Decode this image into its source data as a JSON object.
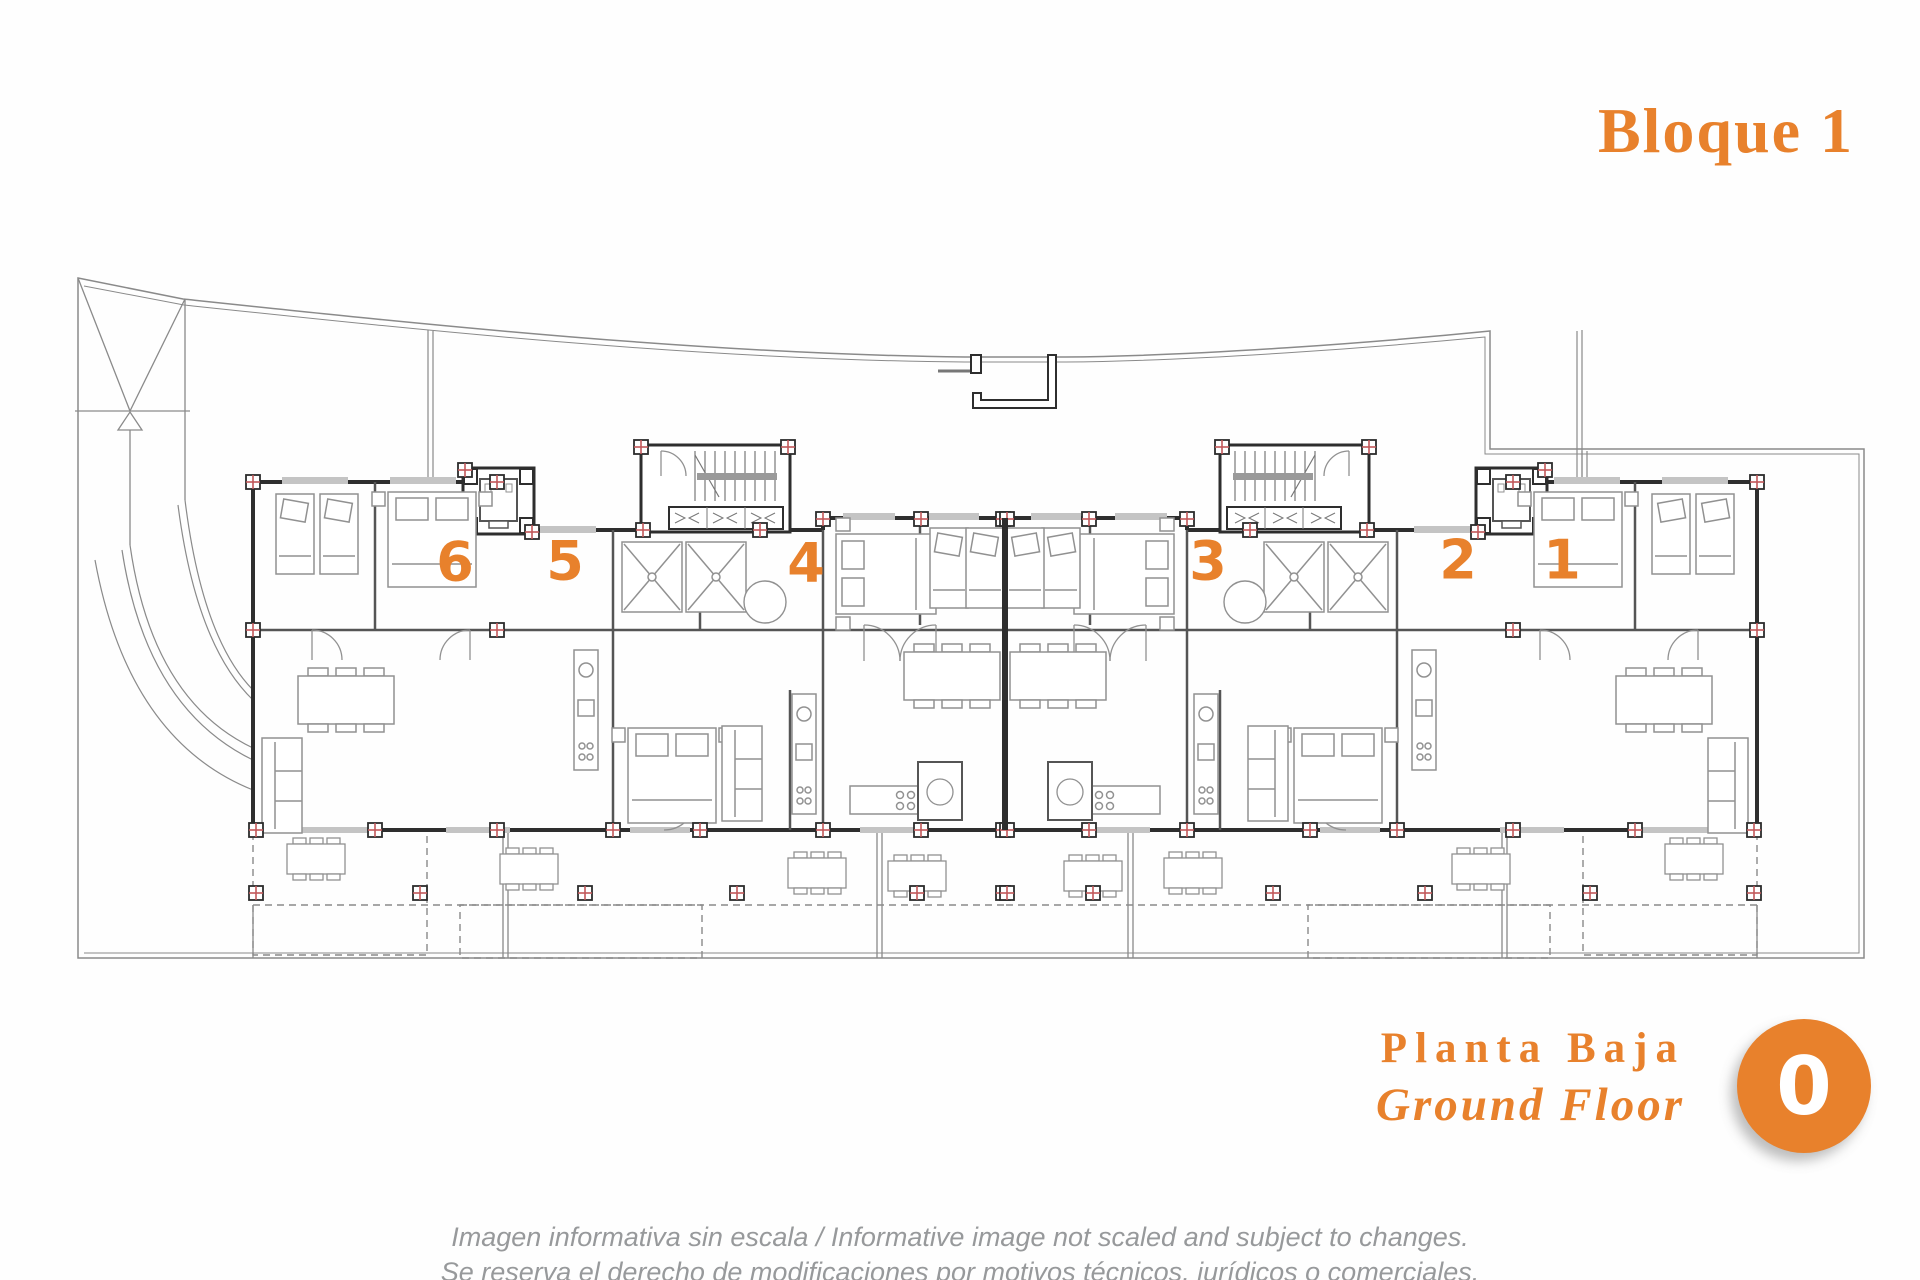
{
  "header": {
    "block_label": "Bloque 1"
  },
  "plan": {
    "units": [
      {
        "label": "6"
      },
      {
        "label": "5"
      },
      {
        "label": "4"
      },
      {
        "label": "3"
      },
      {
        "label": "2"
      },
      {
        "label": "1"
      }
    ]
  },
  "footer": {
    "floor_label_es": "Planta Baja",
    "floor_label_en": "Ground Floor",
    "floor_number": "0"
  },
  "disclaimer": {
    "line1": "Imagen informativa sin escala /  Informative image not scaled and subject to changes.",
    "line2": "Se reserva el derecho de modificaciones por motivos técnicos, jurídicos o comerciales."
  },
  "colors": {
    "accent_orange": "#E8812C",
    "marker_red": "#C2585A",
    "wall_dark": "#2E2E2E",
    "line_light": "#9A9A9A"
  }
}
